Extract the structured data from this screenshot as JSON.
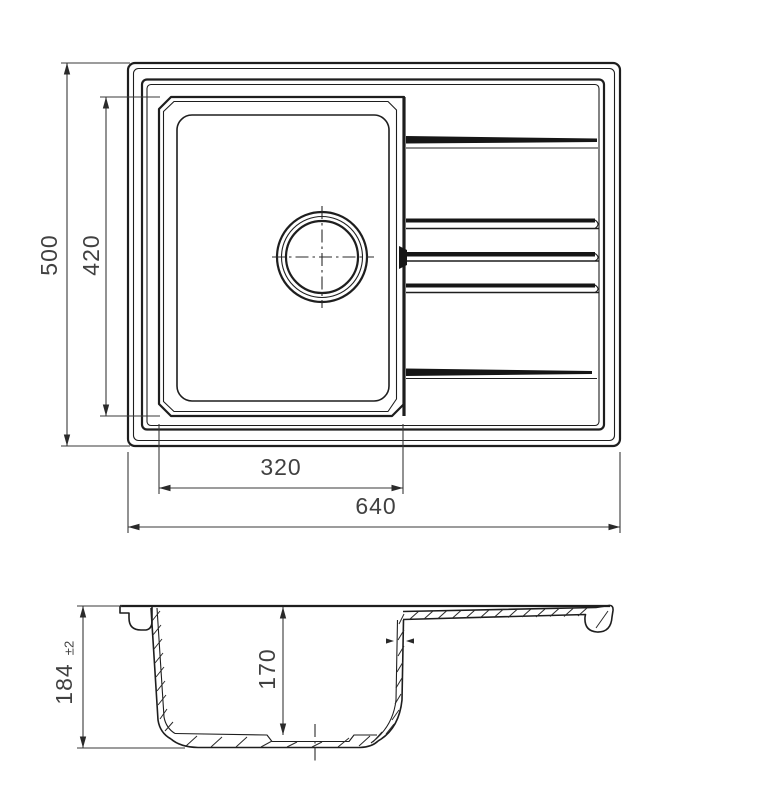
{
  "drawing": {
    "type": "sink-technical-drawing",
    "colors": {
      "line": "#1e1e1e",
      "dim": "#3a3a3a",
      "background": "#ffffff"
    },
    "top_view": {
      "overall_width_mm": "640",
      "overall_depth_mm": "500",
      "bowl_width_mm": "320",
      "bowl_length_mm": "420"
    },
    "side_view": {
      "overall_height_mm": "184",
      "height_tolerance": "±2",
      "bowl_depth_mm": "170"
    }
  }
}
